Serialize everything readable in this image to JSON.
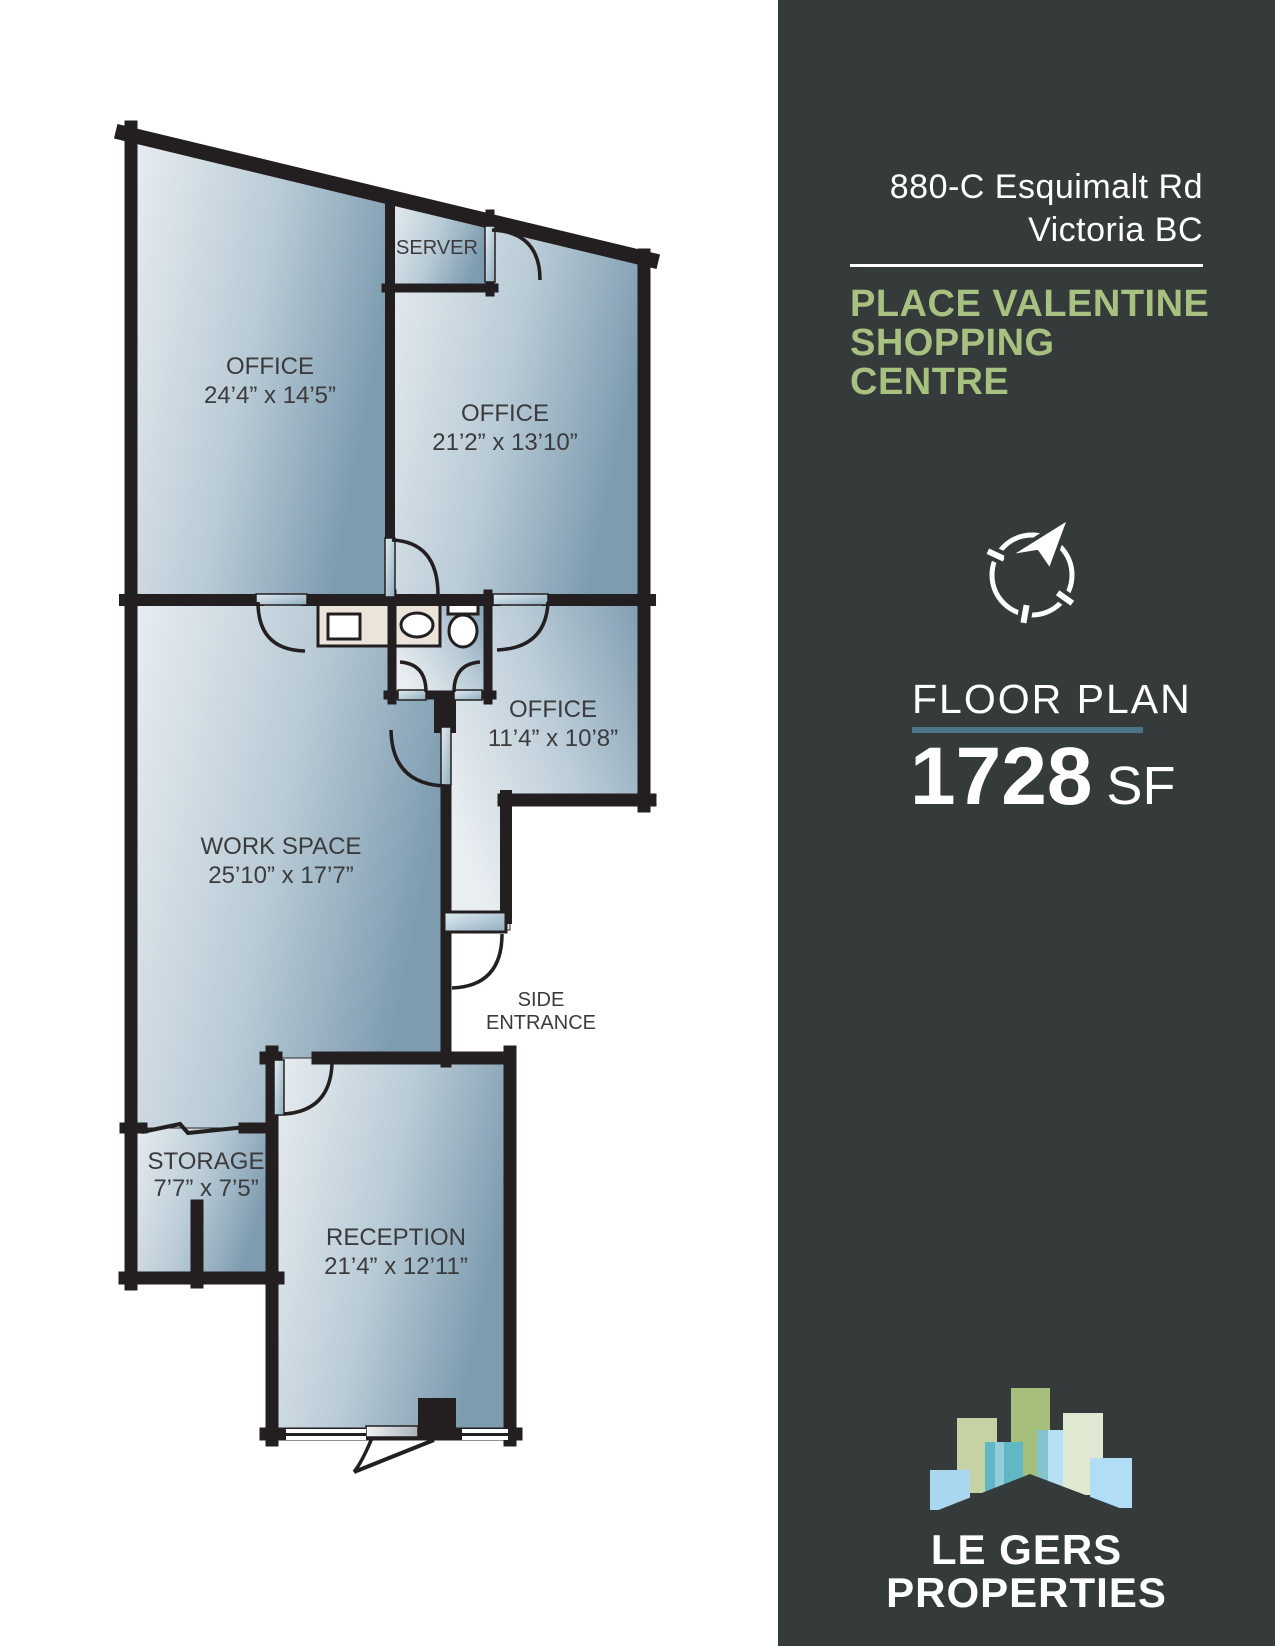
{
  "sidebar": {
    "address": {
      "line1": "880-C Esquimalt Rd",
      "line2": "Victoria BC"
    },
    "property": {
      "line1": "PLACE VALENTINE",
      "line2": "SHOPPING CENTRE"
    },
    "plan": {
      "label": "FLOOR PLAN",
      "area": "1728",
      "unit": "SF"
    },
    "brand": {
      "line1": "LE GERS",
      "line2": "PROPERTIES"
    },
    "colors": {
      "background": "#353b3b",
      "accent_green": "#a7c180",
      "underline_teal": "#4a7587",
      "text": "#ffffff"
    }
  },
  "floor_plan": {
    "colors": {
      "wall": "#231f20",
      "room_light": "#e9eef2",
      "room_steel": "#7e9cb0",
      "counter_beige": "#ece4db",
      "label_text": "#3b3b3d"
    },
    "labels": {
      "office_left": {
        "name": "OFFICE",
        "dims": "24’4” x 14’5”"
      },
      "office_right": {
        "name": "OFFICE",
        "dims": "21’2” x 13’10”"
      },
      "server": {
        "name": "SERVER"
      },
      "office_small": {
        "name": "OFFICE",
        "dims": "11’4” x 10’8”"
      },
      "workspace": {
        "name": "WORK SPACE",
        "dims": "25’10” x 17’7”"
      },
      "storage": {
        "name": "STORAGE",
        "dims": "7’7” x 7’5”"
      },
      "reception": {
        "name": "RECEPTION",
        "dims": "21’4” x 12’11”"
      },
      "side_entrance": {
        "line1": "SIDE",
        "line2": "ENTRANCE"
      }
    }
  }
}
